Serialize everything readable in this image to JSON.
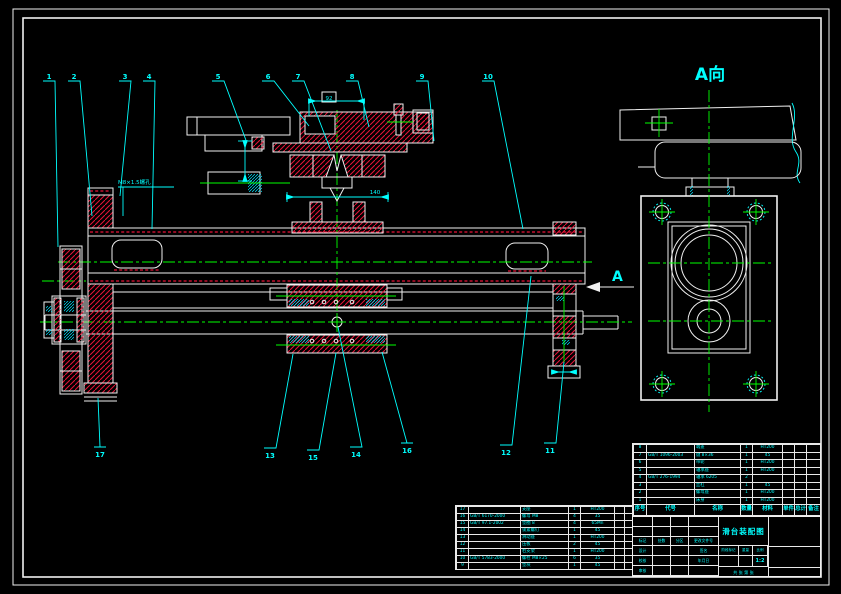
{
  "drawing": {
    "view_label": "A向",
    "direction_letter": "A",
    "thread_label": "M8×1.5螺孔",
    "dim_box": "92",
    "dim_bottom": "140",
    "balloons_top": [
      "1",
      "2",
      "3",
      "4",
      "5",
      "6",
      "7",
      "8",
      "9",
      "10"
    ],
    "balloons_bottom": [
      "17",
      "13",
      "15",
      "14",
      "16",
      "12",
      "11"
    ]
  },
  "colors": {
    "background": "#000000",
    "outline": "#f0f0f0",
    "hatch_red": "#e81338",
    "dimension_cyan": "#00ffff",
    "centerline_green": "#00ff00"
  },
  "bom_right": {
    "header": [
      "序号",
      "代号",
      "名称",
      "数量",
      "材料",
      "单件",
      "总计",
      "备注"
    ],
    "rows": [
      {
        "no": "8",
        "code": "",
        "name": "端盖",
        "qty": "1",
        "mtl": "HT200",
        "note": ""
      },
      {
        "no": "7",
        "code": "GB/T 1096-2003",
        "name": "键 8×36",
        "qty": "1",
        "mtl": "45",
        "note": ""
      },
      {
        "no": "6",
        "code": "",
        "name": "带轮",
        "qty": "1",
        "mtl": "HT200",
        "note": ""
      },
      {
        "no": "5",
        "code": "",
        "name": "轴承座",
        "qty": "1",
        "mtl": "HT200",
        "note": ""
      },
      {
        "no": "4",
        "code": "GB/T 276-1994",
        "name": "轴承 6205",
        "qty": "2",
        "mtl": "",
        "note": ""
      },
      {
        "no": "3",
        "code": "",
        "name": "丝杠",
        "qty": "1",
        "mtl": "45",
        "note": ""
      },
      {
        "no": "2",
        "code": "",
        "name": "螺母座",
        "qty": "1",
        "mtl": "HT200",
        "note": ""
      },
      {
        "no": "1",
        "code": "",
        "name": "床身",
        "qty": "1",
        "mtl": "HT200",
        "note": ""
      }
    ]
  },
  "bom_left": {
    "rows": [
      {
        "no": "17",
        "code": "",
        "name": "支座",
        "qty": "1",
        "mtl": "HT200"
      },
      {
        "no": "16",
        "code": "GB/T 6170-2000",
        "name": "螺母 M8",
        "qty": "4",
        "mtl": "35"
      },
      {
        "no": "15",
        "code": "GB/T 97.1-2002",
        "name": "垫圈 8",
        "qty": "4",
        "mtl": "65Mn"
      },
      {
        "no": "14",
        "code": "",
        "name": "锁紧螺钉",
        "qty": "1",
        "mtl": "45"
      },
      {
        "no": "13",
        "code": "",
        "name": "滑动座",
        "qty": "1",
        "mtl": "HT200"
      },
      {
        "no": "12",
        "code": "",
        "name": "压板",
        "qty": "2",
        "mtl": "45"
      },
      {
        "no": "11",
        "code": "",
        "name": "右支架",
        "qty": "1",
        "mtl": "HT200"
      },
      {
        "no": "10",
        "code": "GB/T 5783-2000",
        "name": "螺栓 M8×25",
        "qty": "6",
        "mtl": "35"
      },
      {
        "no": "9",
        "code": "",
        "name": "垫块",
        "qty": "1",
        "mtl": "45"
      }
    ]
  },
  "titleblock": {
    "name": "滑台装配图",
    "left_grid": [
      [
        "",
        "",
        "",
        ""
      ],
      [
        "",
        "",
        "",
        ""
      ],
      [
        "标记",
        "处数",
        "分区",
        "更改文件号"
      ],
      [
        "设计",
        "",
        "",
        "签名"
      ],
      [
        "校核",
        "",
        "",
        "年月日"
      ],
      [
        "审核",
        "",
        "",
        ""
      ]
    ],
    "stage_label": "阶段标记",
    "weight_label": "重量",
    "scale_label": "比例",
    "scale_value": "1:2",
    "sheet_label": "共 张 第 张"
  }
}
